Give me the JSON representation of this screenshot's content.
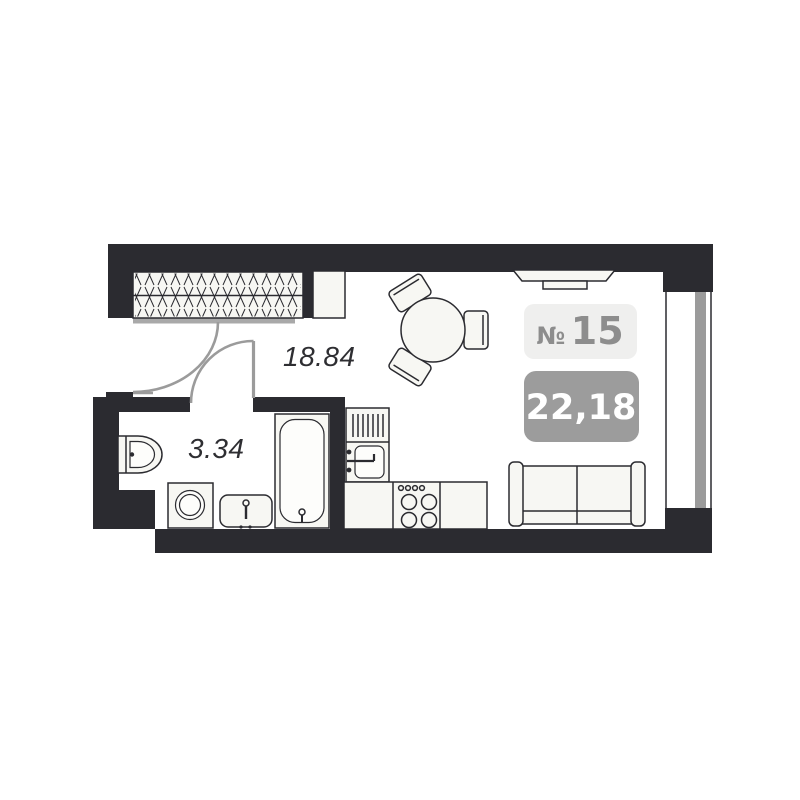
{
  "title": "apartment-floor-plan",
  "unit": {
    "prefix": "№",
    "number": "15",
    "area": "22,18"
  },
  "rooms": {
    "living": {
      "area": "18.84"
    },
    "bathroom": {
      "area": "3.34"
    }
  },
  "colors": {
    "wall": "#2b2b30",
    "door_swing": "#9b9b9b",
    "window_glass": "#9b9b9b",
    "unit_badge_bg": "#efefee",
    "unit_badge_text": "#8d8d8d",
    "area_badge_bg": "#9c9c9c",
    "area_badge_text": "#ffffff",
    "area_label_text": "#2e2e32",
    "furniture_fill": "#f7f7f3"
  }
}
